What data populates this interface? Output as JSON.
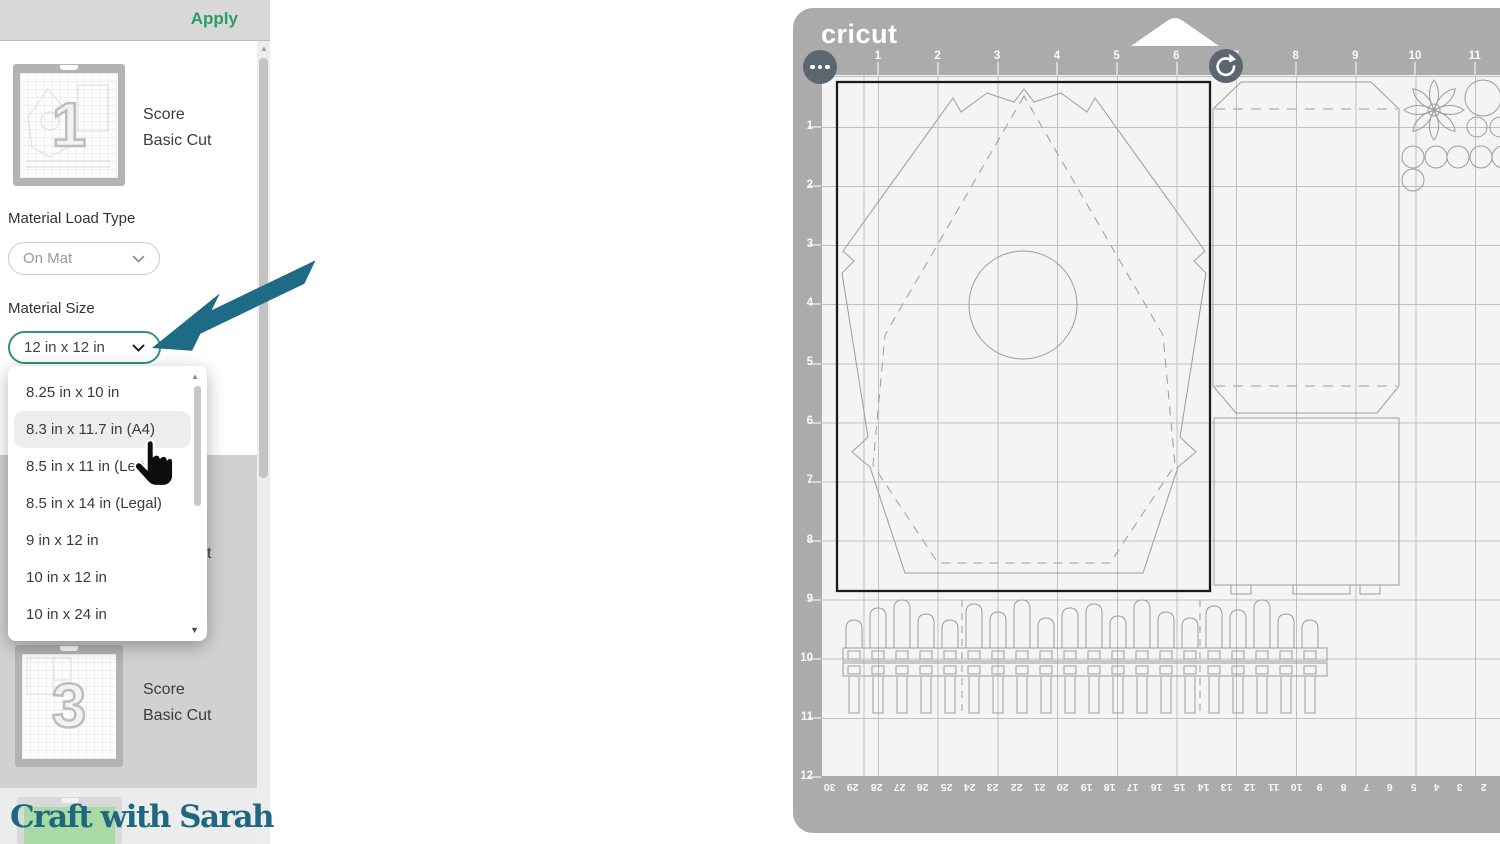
{
  "colors": {
    "accent_teal": "#1d6b85",
    "cricut_green": "#2d9b69",
    "selected_border": "#339180",
    "logo_teal": "#1d6880",
    "mat_frame": "#ababab",
    "green_mat": "#a9d9a4"
  },
  "topbar": {
    "apply_label": "Apply"
  },
  "sidebar": {
    "mats": [
      {
        "number": "1",
        "layers": [
          "Score",
          "Basic Cut"
        ]
      },
      {
        "number": "2",
        "layers": [
          "Score",
          "Basic Cut"
        ]
      },
      {
        "number": "3",
        "layers": [
          "Score",
          "Basic Cut"
        ]
      }
    ],
    "material_load_type": {
      "label": "Material Load Type",
      "value": "On Mat"
    },
    "material_size": {
      "label": "Material Size",
      "value": "12 in x 12 in"
    },
    "size_dropdown": {
      "options": [
        "8.25 in x 10 in",
        "8.3 in x 11.7 in (A4)",
        "8.5 in x 11 in (Letter)",
        "8.5 in x 14 in (Legal)",
        "9 in x 12 in",
        "10 in x 12 in",
        "10 in x 24 in"
      ],
      "hovered": "8.3 in x 11.7 in (A4)"
    }
  },
  "watermark": {
    "text": "Craft with Sarah"
  },
  "mat_preview": {
    "brand": "cricut",
    "ruler_top": [
      "1",
      "2",
      "3",
      "4",
      "5",
      "6",
      "7",
      "8",
      "9",
      "10",
      "11"
    ],
    "ruler_left": [
      "1",
      "2",
      "3",
      "4",
      "5",
      "6",
      "7",
      "8",
      "9",
      "10",
      "11",
      "12"
    ],
    "ruler_bottom_cm": [
      "30",
      "29",
      "28",
      "27",
      "26",
      "25",
      "24",
      "23",
      "22",
      "21",
      "20",
      "19",
      "18",
      "17",
      "16",
      "15",
      "14",
      "13",
      "12",
      "11",
      "10",
      "9",
      "8",
      "7",
      "6",
      "5",
      "4",
      "3",
      "2"
    ]
  }
}
